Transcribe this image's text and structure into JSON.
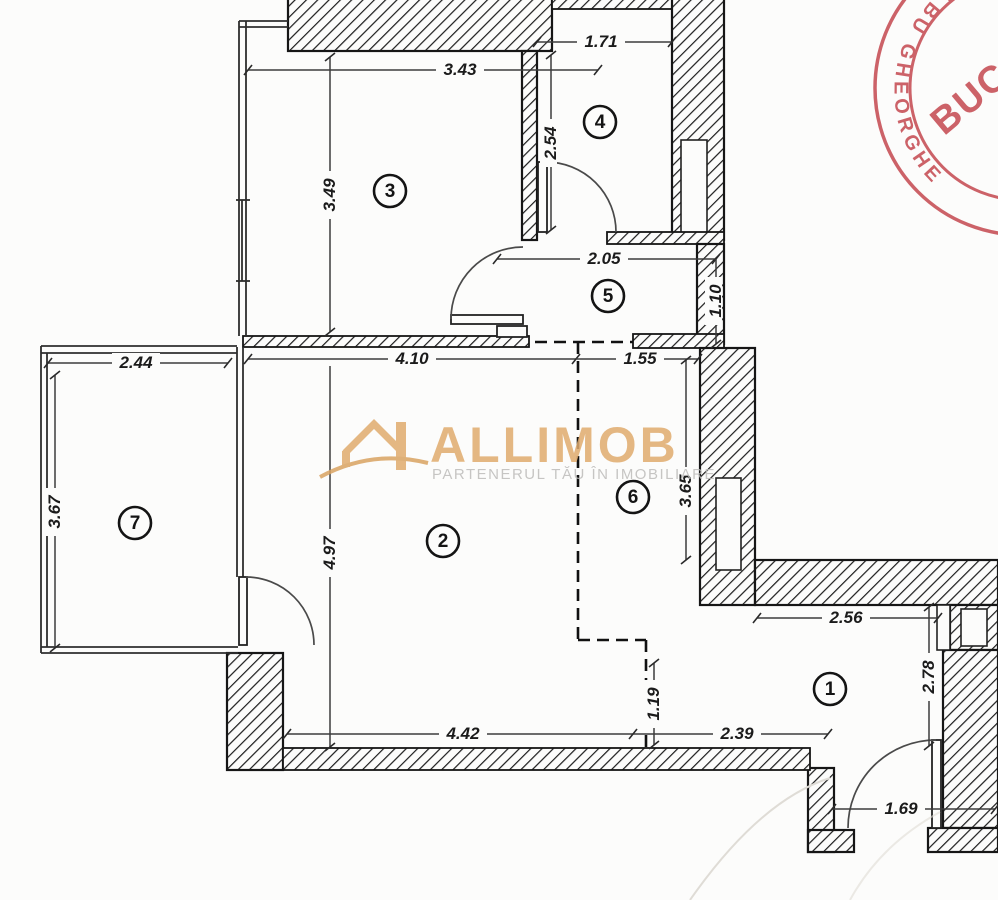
{
  "watermark": {
    "brand": "ALLIMOB",
    "tagline": "PARTENERUL TĂU ÎN IMOBILIARE",
    "brand_color": "#E0AC6E",
    "tagline_color": "#BDBCBA"
  },
  "stamp": {
    "ring_text": "ALBU GHEORGHE",
    "center_text": "BUC",
    "color": "#C4484F"
  },
  "rooms": [
    {
      "number": "1"
    },
    {
      "number": "2"
    },
    {
      "number": "3"
    },
    {
      "number": "4"
    },
    {
      "number": "5"
    },
    {
      "number": "6"
    },
    {
      "number": "7"
    }
  ],
  "dimensions": [
    {
      "value": "3.43"
    },
    {
      "value": "3.49"
    },
    {
      "value": "1.71"
    },
    {
      "value": "2.54"
    },
    {
      "value": "2.05"
    },
    {
      "value": "1.10"
    },
    {
      "value": "4.10"
    },
    {
      "value": "1.55"
    },
    {
      "value": "2.44"
    },
    {
      "value": "3.67"
    },
    {
      "value": "4.97"
    },
    {
      "value": "3.65"
    },
    {
      "value": "2.56"
    },
    {
      "value": "2.78"
    },
    {
      "value": "1.19"
    },
    {
      "value": "4.42"
    },
    {
      "value": "2.39"
    },
    {
      "value": "1.69"
    }
  ]
}
